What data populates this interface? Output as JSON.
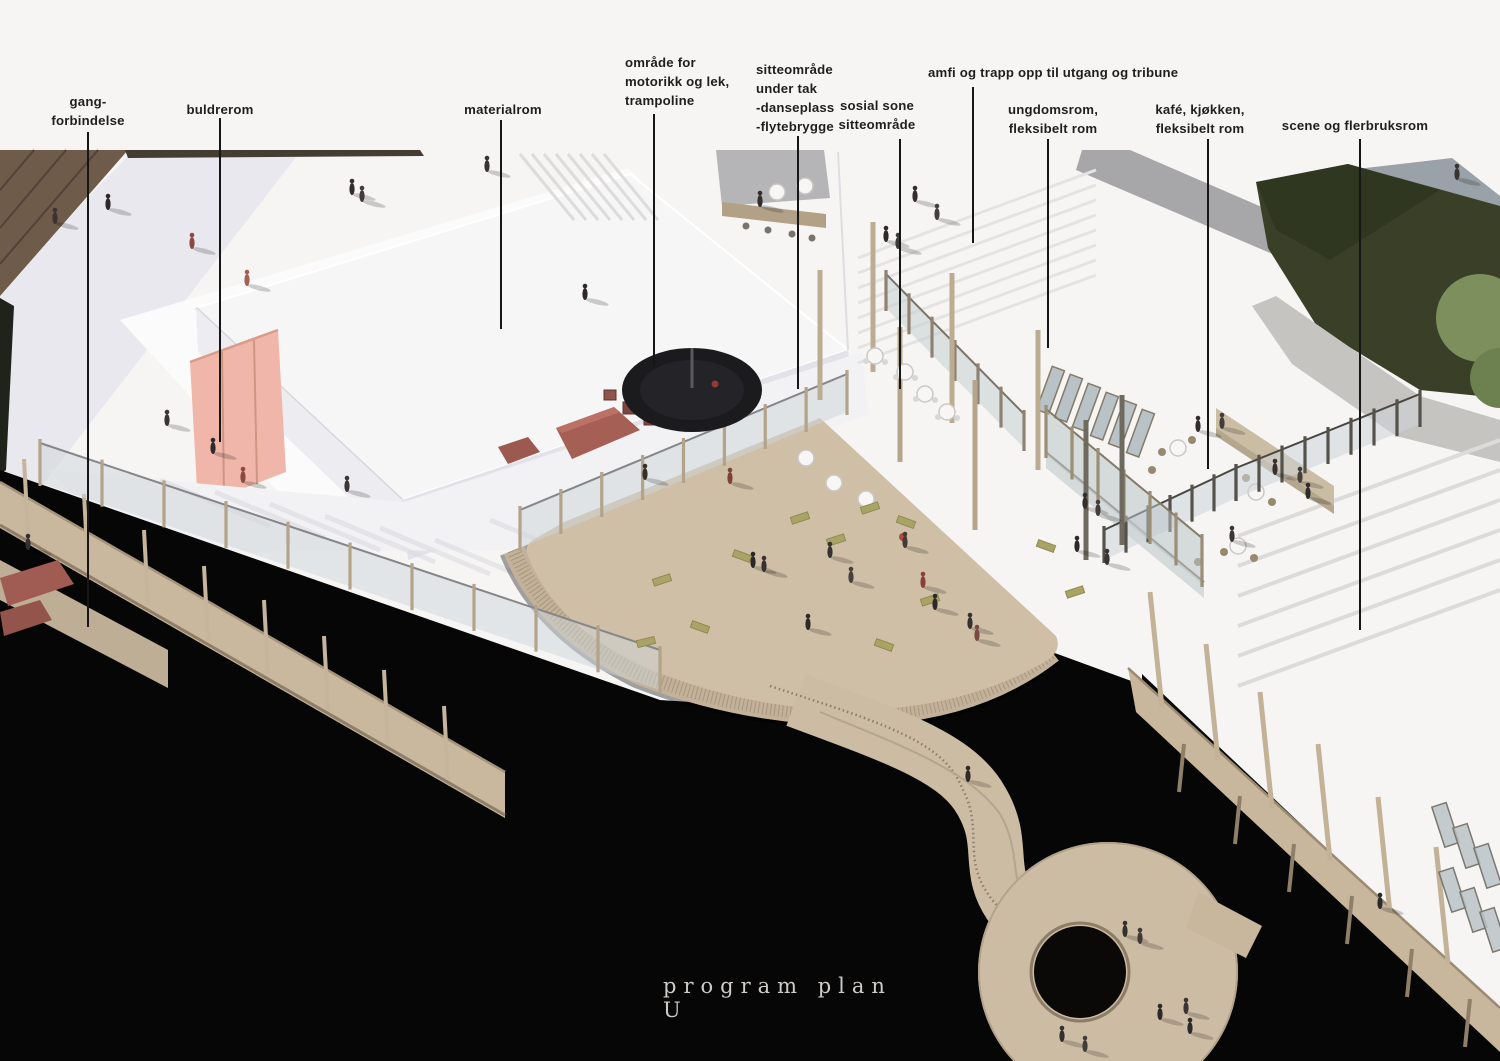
{
  "title": {
    "text": "program plan U"
  },
  "callouts": [
    {
      "id": "gang-forbindelse",
      "text": "gang-\nforbindelse"
    },
    {
      "id": "buldrerom",
      "text": "buldrerom"
    },
    {
      "id": "materialrom",
      "text": "materialrom"
    },
    {
      "id": "omrade-motorikk-lek-trampoline",
      "text": "område for\nmotorikk og lek,\ntrampoline"
    },
    {
      "id": "sitteomrade-under-tak",
      "text": "sitteområde\nunder tak\n-danseplass\n-flytebrygge"
    },
    {
      "id": "sosial-sone-sitteomrade",
      "text": "sosial sone\nsitteområde"
    },
    {
      "id": "amfi-trapp",
      "text": "amfi og trapp opp til utgang og tribune"
    },
    {
      "id": "ungdomsrom",
      "text": "ungdomsrom,\nfleksibelt rom"
    },
    {
      "id": "kafe-kjokken",
      "text": "kafé, kjøkken,\nfleksibelt rom"
    },
    {
      "id": "scene-flerbruksrom",
      "text": "scene og flerbruksrom"
    }
  ],
  "colors": {
    "water": "#070606",
    "deck_wood": "#cdbca4",
    "pink_wall": "#f0b6aa",
    "gym_mats": "#a65f55",
    "lawn": "#3a4027",
    "bench_green": "#a9a465",
    "leader_line": "#161616",
    "label_text": "#1f1f1f",
    "title_text": "#cfcbc7"
  }
}
